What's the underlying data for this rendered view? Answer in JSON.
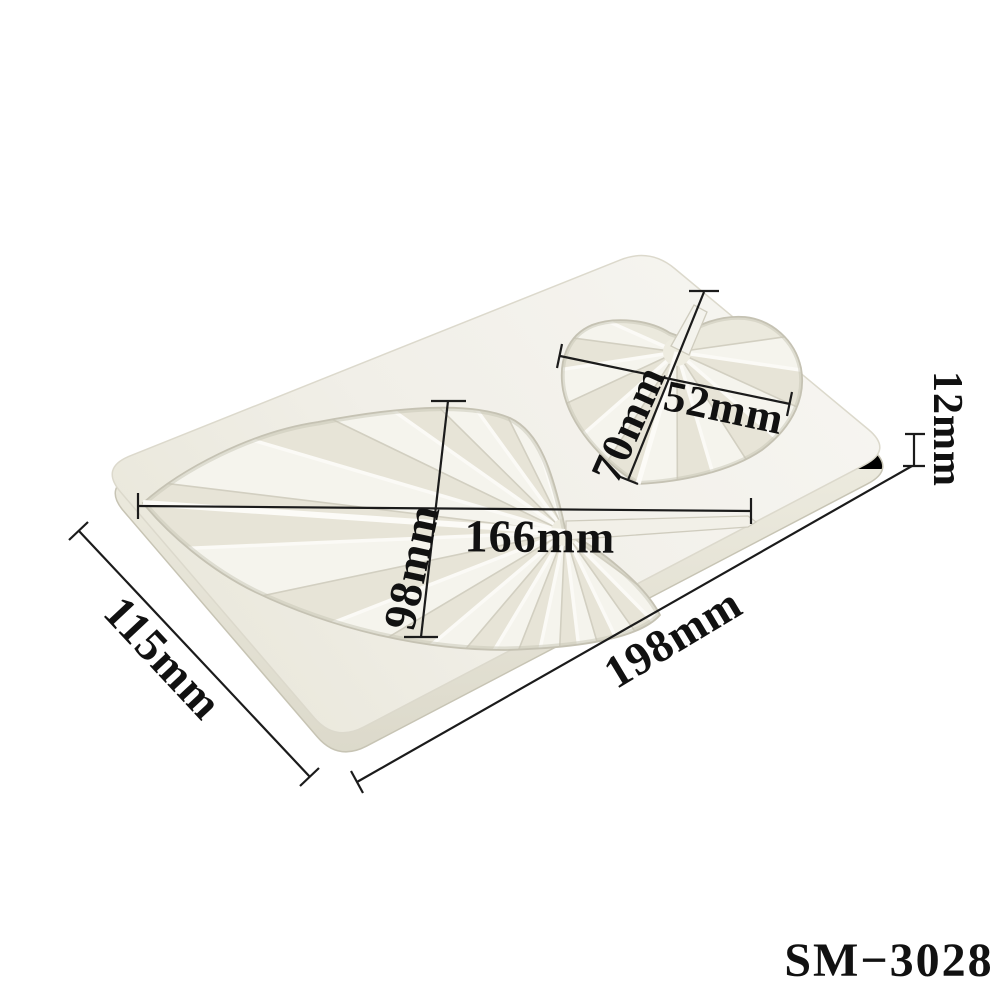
{
  "background_color": "#ffffff",
  "product_code": "SM−3028",
  "annotation": {
    "line_color": "#1b1b1b",
    "text_color": "#111111",
    "labels": {
      "large_leaf_length": "166mm",
      "large_leaf_width": "98mm",
      "small_leaf_width": "52mm",
      "small_leaf_length": "70mm",
      "thickness": "12mm",
      "mold_short_side": "115mm",
      "mold_long_side": "198mm"
    }
  },
  "mold": {
    "subject": "white silicone fondant mold with two pleated leaf cavities",
    "surface_color": "#f2f1ea",
    "side_color": "#e2dfd1",
    "cavity_color": "#ebe9dd",
    "pleat_highlight": "#fbfaf6",
    "pleat_shadow": "#d2cfc1"
  }
}
